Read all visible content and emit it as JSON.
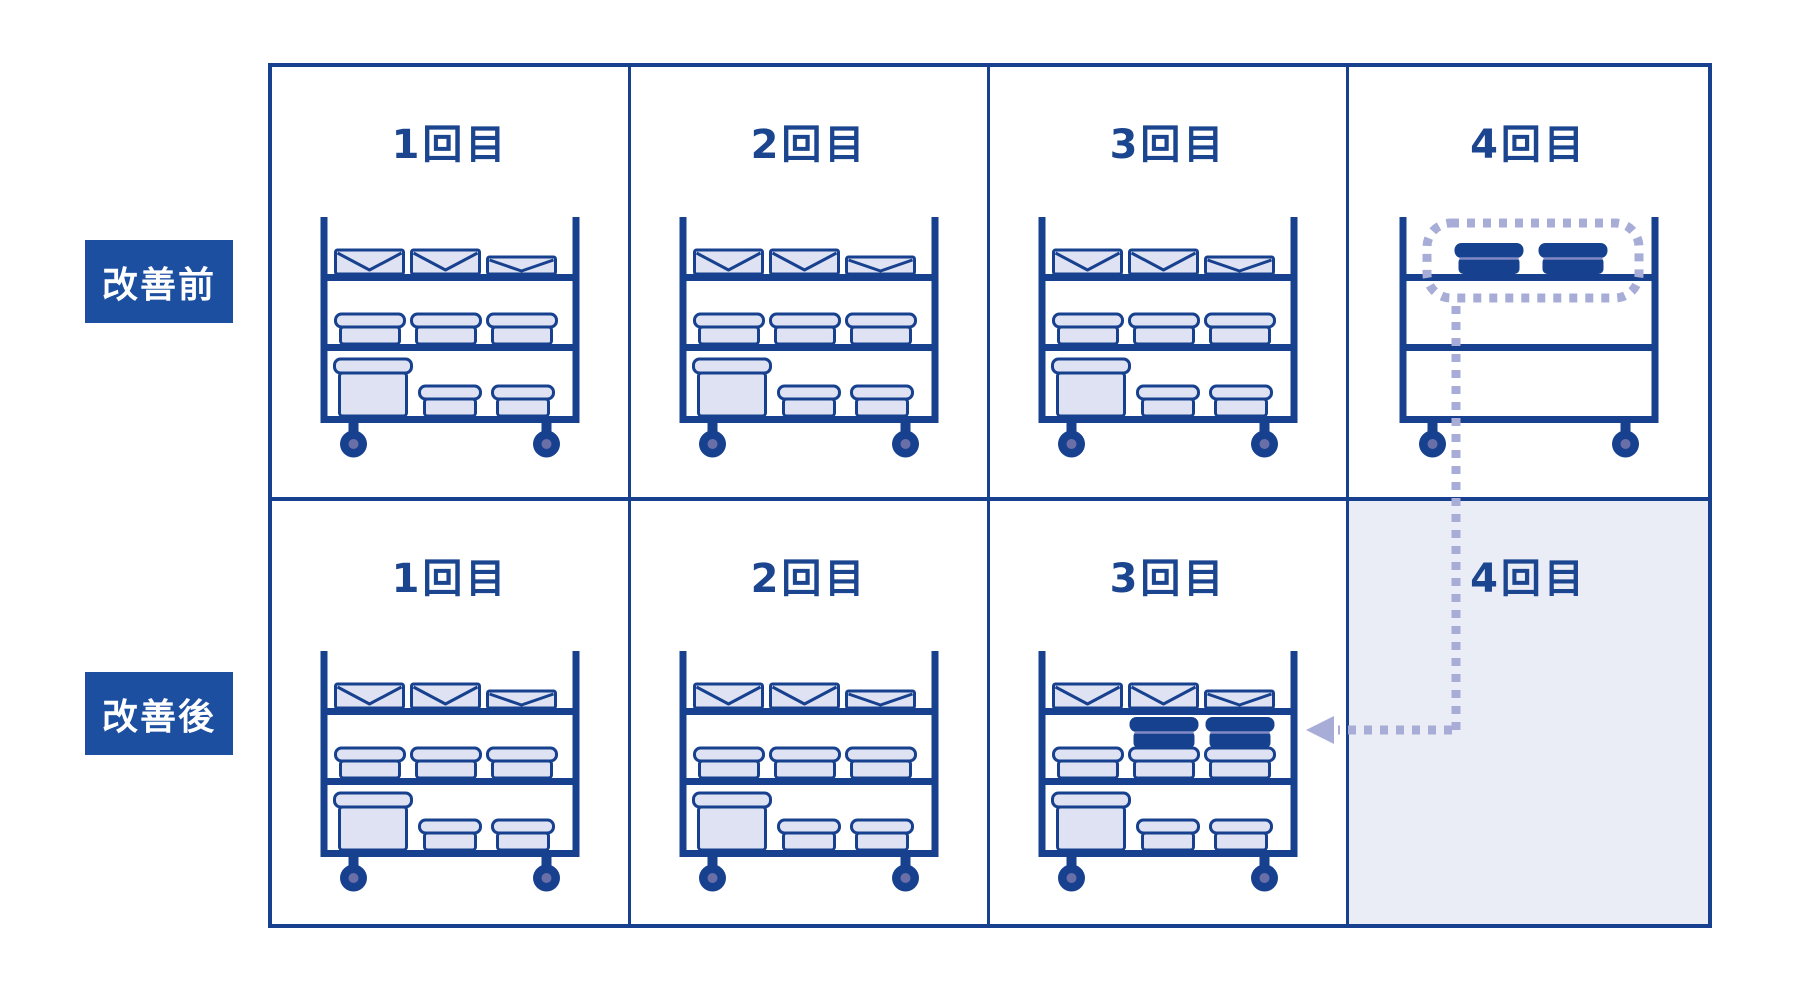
{
  "diagram_title": "",
  "rows": [
    {
      "label": "改善前",
      "cells": [
        {
          "header": "1回目",
          "cart": "full"
        },
        {
          "header": "2回目",
          "cart": "full"
        },
        {
          "header": "3回目",
          "cart": "full"
        },
        {
          "header": "4回目",
          "cart": "two-dark-top",
          "highlighted": true
        }
      ]
    },
    {
      "label": "改善後",
      "cells": [
        {
          "header": "1回目",
          "cart": "full"
        },
        {
          "header": "2回目",
          "cart": "full"
        },
        {
          "header": "3回目",
          "cart": "full-plus-two-dark"
        },
        {
          "header": "4回目",
          "cart": "none",
          "shaded": true
        }
      ]
    }
  ],
  "cart_variants": {
    "full": {
      "top_shelf": [
        "envelope",
        "envelope",
        "envelope-small"
      ],
      "middle_shelf": [
        "container",
        "container",
        "container"
      ],
      "bottom_shelf": [
        "container-large",
        "container-small",
        "container-small"
      ]
    },
    "two-dark-top": {
      "top_shelf": [
        "dark-container",
        "dark-container"
      ],
      "middle_shelf": [],
      "bottom_shelf": []
    },
    "full-plus-two-dark": {
      "top_shelf": [
        "envelope",
        "envelope",
        "envelope-small"
      ],
      "middle_shelf": [
        "container",
        "container+dark-container-on-top",
        "container+dark-container-on-top"
      ],
      "bottom_shelf": [
        "container-large",
        "container-small",
        "container-small"
      ]
    },
    "none": {}
  },
  "annotation": {
    "type": "dotted-move-arrow",
    "from": "before-round4-top-shelf-items",
    "to": "after-round3-middle-shelf",
    "highlight": "dotted-rounded-box-around-top-shelf-items"
  },
  "colors": {
    "line_blue": "#17418F",
    "label_box_blue": "#1D4FA0",
    "header_text_blue": "#1C4590",
    "item_fill": "#DEE2F2",
    "dark_item": "#15418E",
    "dark_item_seam": "#8089C4",
    "wheel_hub": "#6B6FA8",
    "dotted_accent": "#A8ADD8",
    "shaded_cell_bg": "#EAECF6",
    "background": "#FFFFFF"
  }
}
